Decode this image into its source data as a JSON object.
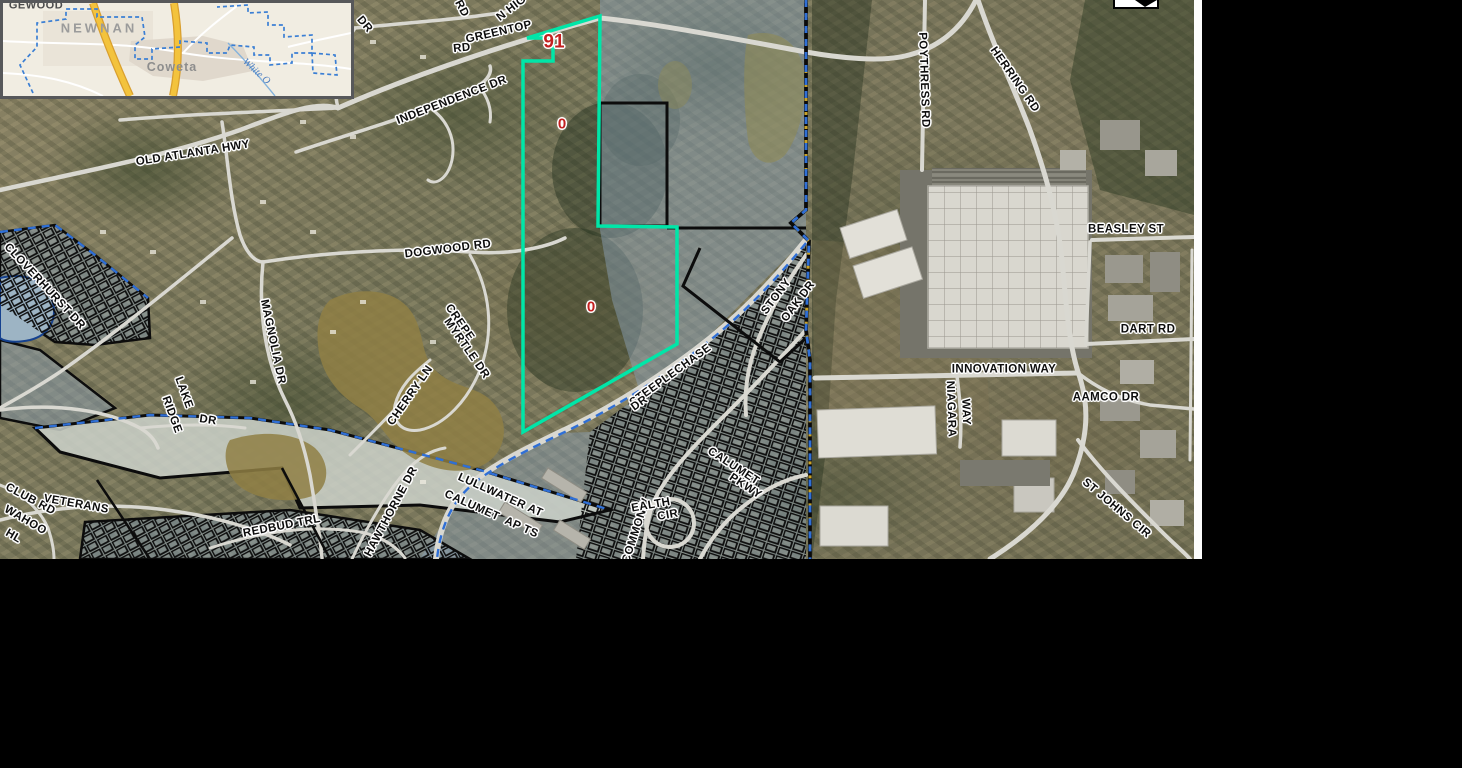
{
  "app": {
    "description": "County GIS parcel viewer aerial map with subject parcel highlighted",
    "colors": {
      "parcel_highlight": "#00e6a8",
      "parcel_id_red": "#c32020",
      "flood_overlay": "rgba(137,160,184,0.48)",
      "county_boundary_blue": "#2f6fd6",
      "parcel_line_black": "#0c0c0c",
      "road_fill": "#d9d8d1",
      "inset_highway_yellow": "#f3c33d",
      "inset_boundary_blue": "#3b7fd4",
      "page_background": "#000000"
    },
    "icons": [
      {
        "name": "cropped-north-arrow-widget",
        "glyph": "black triangle in white box, cut off at top edge"
      }
    ]
  },
  "map": {
    "road_labels": [
      {
        "t": "N HIG",
        "x": 512,
        "y": 9,
        "r": -38,
        "c": "road"
      },
      {
        "t": "RD",
        "x": 461,
        "y": 9,
        "r": 62,
        "c": "road"
      },
      {
        "t": "GREENTOP",
        "x": 499,
        "y": 33,
        "r": -13,
        "c": "road"
      },
      {
        "t": "RD",
        "x": 462,
        "y": 49,
        "r": -6,
        "c": "road"
      },
      {
        "t": "DR",
        "x": 364,
        "y": 25,
        "r": 50,
        "c": "road"
      },
      {
        "t": "INDEPENDENCE DR",
        "x": 452,
        "y": 101,
        "r": -21,
        "c": "road"
      },
      {
        "t": "OLD ATLANTA HWY",
        "x": 193,
        "y": 154,
        "r": -9,
        "c": "road"
      },
      {
        "t": "DOGWOOD RD",
        "x": 448,
        "y": 250,
        "r": -7,
        "c": "road"
      },
      {
        "t": "MAGNOLIA DR",
        "x": 272,
        "y": 342,
        "r": 78,
        "c": "road"
      },
      {
        "t": "CREPE",
        "x": 459,
        "y": 323,
        "r": 55,
        "c": "road"
      },
      {
        "t": "MYRTLE DR",
        "x": 466,
        "y": 349,
        "r": 55,
        "c": "road"
      },
      {
        "t": "CHERRY LN",
        "x": 411,
        "y": 396,
        "r": -55,
        "c": "road"
      },
      {
        "t": "CLOVERHURST DR",
        "x": 44,
        "y": 287,
        "r": 47,
        "c": "road"
      },
      {
        "t": "LAKE",
        "x": 183,
        "y": 393,
        "r": 70,
        "c": "road"
      },
      {
        "t": "RIDGE",
        "x": 171,
        "y": 415,
        "r": 70,
        "c": "road"
      },
      {
        "t": "DR",
        "x": 208,
        "y": 421,
        "r": 8,
        "c": "road"
      },
      {
        "t": "CLUB RD",
        "x": 30,
        "y": 500,
        "r": 28,
        "c": "road"
      },
      {
        "t": "VETERANS",
        "x": 76,
        "y": 505,
        "r": 10,
        "c": "road"
      },
      {
        "t": "WAHOO",
        "x": 25,
        "y": 521,
        "r": 30,
        "c": "road"
      },
      {
        "t": "HL",
        "x": 13,
        "y": 537,
        "r": 30,
        "c": "road"
      },
      {
        "t": "REDBUD TRL",
        "x": 282,
        "y": 527,
        "r": -11,
        "c": "road"
      },
      {
        "t": "HAWTHORNE DR",
        "x": 392,
        "y": 512,
        "r": -62,
        "c": "road"
      },
      {
        "t": "LULLWATER AT",
        "x": 500,
        "y": 496,
        "r": 24,
        "c": "road"
      },
      {
        "t": "CALUMET  AP TS",
        "x": 491,
        "y": 515,
        "r": 24,
        "c": "road"
      },
      {
        "t": "STEEPLECHASE",
        "x": 671,
        "y": 376,
        "r": -36,
        "c": "road"
      },
      {
        "t": "DR",
        "x": 640,
        "y": 404,
        "r": -36,
        "c": "road"
      },
      {
        "t": "STONY",
        "x": 777,
        "y": 297,
        "r": -53,
        "c": "road"
      },
      {
        "t": "OAK DR",
        "x": 799,
        "y": 302,
        "r": -53,
        "c": "road"
      },
      {
        "t": "COMMONW",
        "x": 637,
        "y": 531,
        "r": -72,
        "c": "road"
      },
      {
        "t": "EALTH",
        "x": 651,
        "y": 506,
        "r": -10,
        "c": "road"
      },
      {
        "t": "CIR",
        "x": 668,
        "y": 516,
        "r": -10,
        "c": "road"
      },
      {
        "t": "CALUMET",
        "x": 733,
        "y": 467,
        "r": 33,
        "c": "road"
      },
      {
        "t": "PKWY",
        "x": 745,
        "y": 487,
        "r": 33,
        "c": "road"
      },
      {
        "t": "POYTHRESS RD",
        "x": 923,
        "y": 80,
        "r": 88,
        "c": "road"
      },
      {
        "t": "HERRING RD",
        "x": 1014,
        "y": 80,
        "r": 55,
        "c": "road"
      },
      {
        "t": "BEASLEY ST",
        "x": 1126,
        "y": 230,
        "r": 0,
        "c": "road"
      },
      {
        "t": "DART RD",
        "x": 1148,
        "y": 330,
        "r": 0,
        "c": "road"
      },
      {
        "t": "INNOVATION WAY",
        "x": 1004,
        "y": 370,
        "r": 0,
        "c": "road"
      },
      {
        "t": "AAMCO DR",
        "x": 1106,
        "y": 398,
        "r": 0,
        "c": "road"
      },
      {
        "t": "NIAGARA",
        "x": 950,
        "y": 409,
        "r": 88,
        "c": "road"
      },
      {
        "t": "WAY",
        "x": 965,
        "y": 412,
        "r": 88,
        "c": "road"
      },
      {
        "t": "ST JOHNS CIR",
        "x": 1116,
        "y": 509,
        "r": 40,
        "c": "road"
      }
    ],
    "parcel_labels": [
      {
        "t": "91",
        "x": 554,
        "y": 42,
        "r": 0,
        "c": "red-lg"
      },
      {
        "t": "0",
        "x": 562,
        "y": 124,
        "r": 0,
        "c": "red"
      },
      {
        "t": "0",
        "x": 591,
        "y": 307,
        "r": 0,
        "c": "red"
      }
    ]
  },
  "inset": {
    "labels": [
      {
        "t": "NEWNAN",
        "x": 96,
        "y": 25,
        "r": 0,
        "c": "city-major"
      },
      {
        "t": "Coweta",
        "x": 169,
        "y": 64,
        "r": 0,
        "c": "city-minor"
      },
      {
        "t": "White O",
        "x": 253,
        "y": 69,
        "r": 42,
        "c": "creek"
      },
      {
        "t": "GEWOOD",
        "x": 33,
        "y": 3,
        "r": 0,
        "c": "cut-label"
      }
    ]
  }
}
